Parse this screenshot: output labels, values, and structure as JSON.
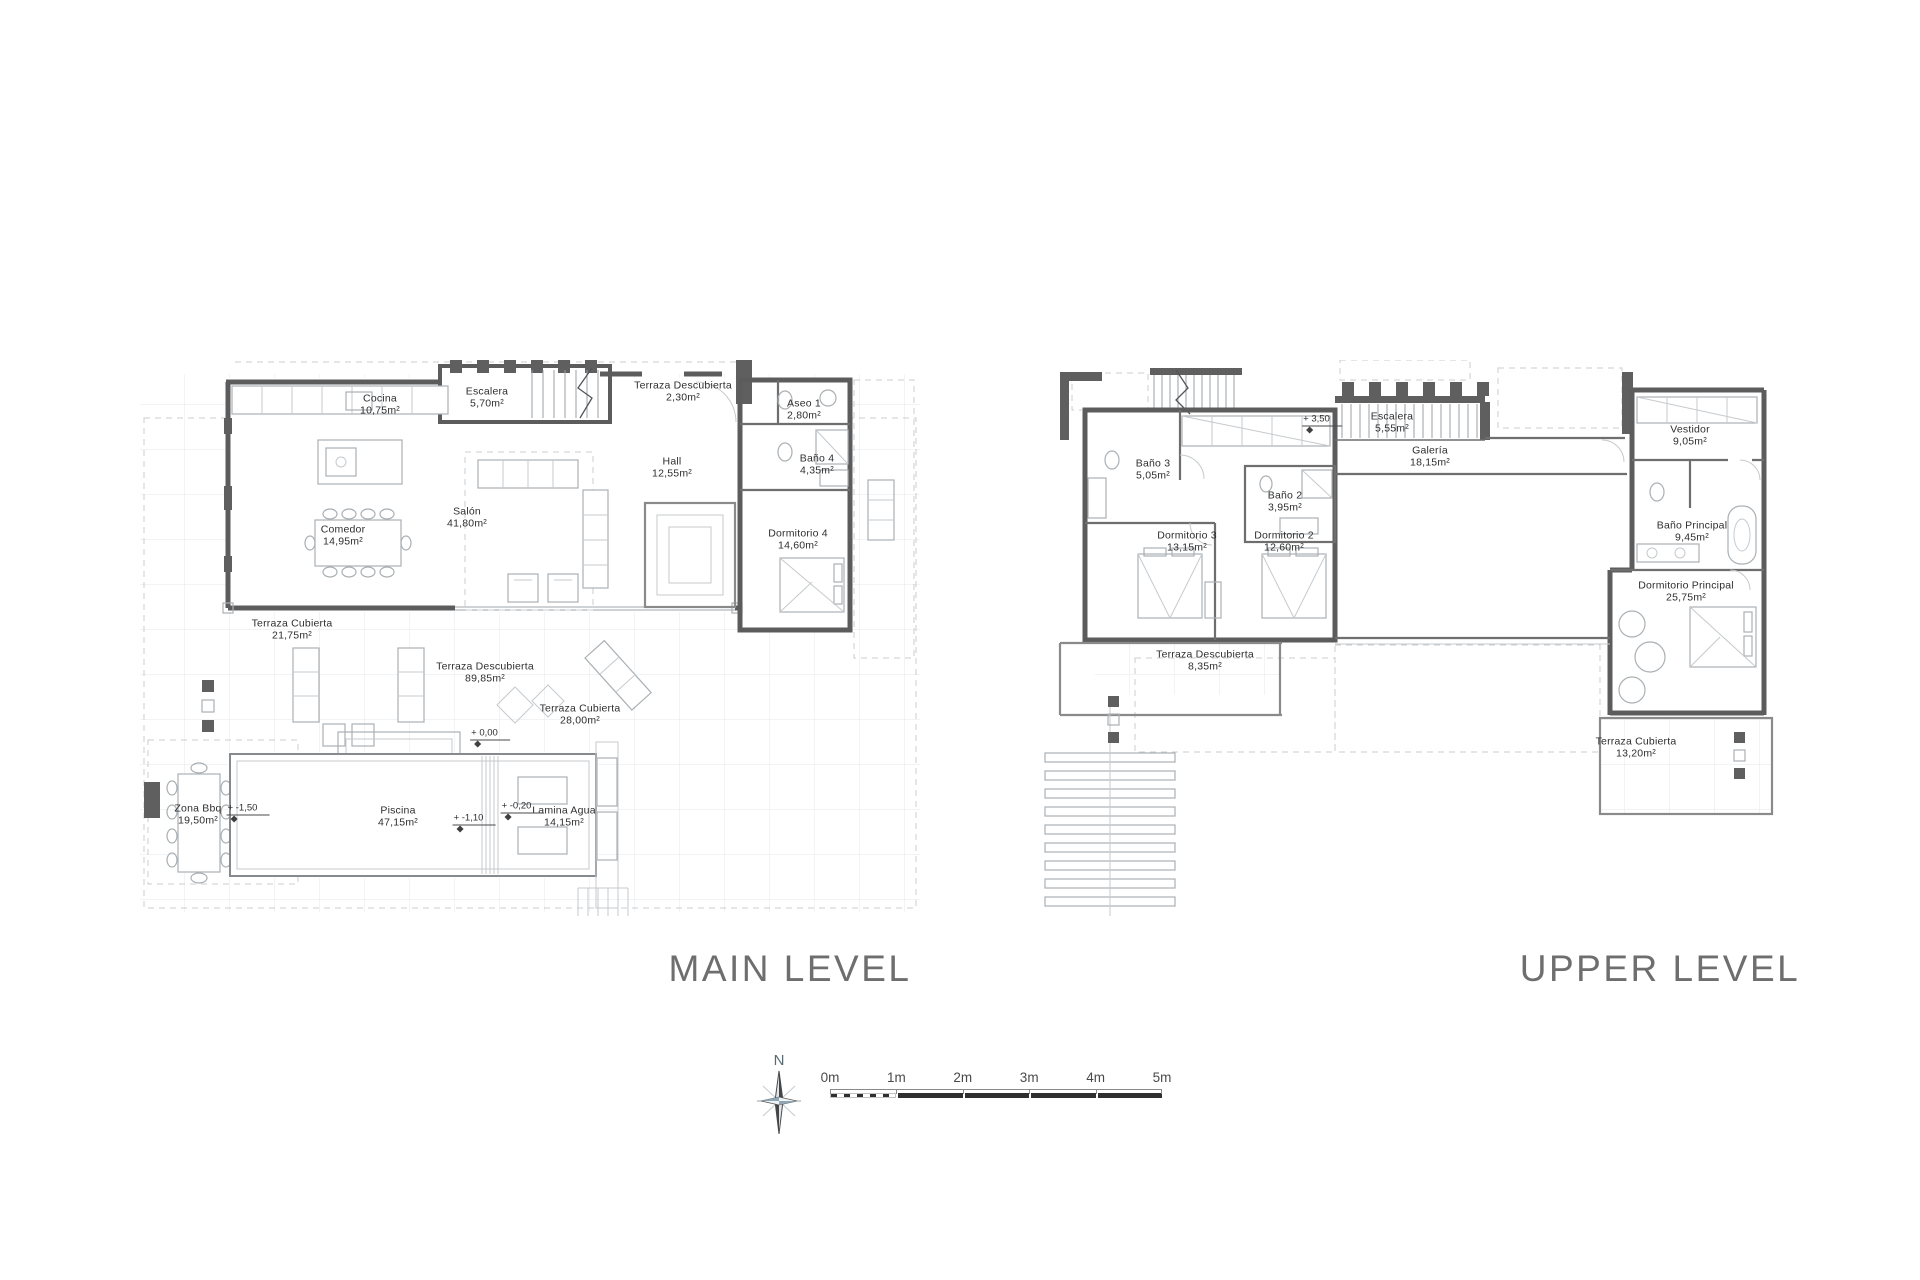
{
  "plans": {
    "main": {
      "title": "MAIN LEVEL",
      "rooms": [
        {
          "name": "Cocina",
          "area": "10,75m²"
        },
        {
          "name": "Escalera",
          "area": "5,70m²"
        },
        {
          "name": "Terraza Descubierta",
          "area": "2,30m²"
        },
        {
          "name": "Aseo 1",
          "area": "2,80m²"
        },
        {
          "name": "Baño 4",
          "area": "4,35m²"
        },
        {
          "name": "Hall",
          "area": "12,55m²"
        },
        {
          "name": "Salón",
          "area": "41,80m²"
        },
        {
          "name": "Comedor",
          "area": "14,95m²"
        },
        {
          "name": "Dormitorio 4",
          "area": "14,60m²"
        },
        {
          "name": "Terraza Cubierta",
          "area": "21,75m²"
        },
        {
          "name": "Terraza Descubierta",
          "area": "89,85m²"
        },
        {
          "name": "Terraza Cubierta",
          "area": "28,00m²"
        },
        {
          "name": "Piscina",
          "area": "47,15m²"
        },
        {
          "name": "Lamina Agua",
          "area": "14,15m²"
        },
        {
          "name": "Zona Bbq",
          "area": "19,50m²"
        }
      ],
      "levels": [
        {
          "label": "+ 0,00"
        },
        {
          "label": "+ -1,50"
        },
        {
          "label": "+ -1,10"
        },
        {
          "label": "+ -0,20"
        }
      ]
    },
    "upper": {
      "title": "UPPER LEVEL",
      "rooms": [
        {
          "name": "Baño 3",
          "area": "5,05m²"
        },
        {
          "name": "Escalera",
          "area": "5,55m²"
        },
        {
          "name": "Galería",
          "area": "18,15m²"
        },
        {
          "name": "Baño 2",
          "area": "3,95m²"
        },
        {
          "name": "Dormitorio 3",
          "area": "13,15m²"
        },
        {
          "name": "Dormitorio 2",
          "area": "12,60m²"
        },
        {
          "name": "Terraza Descubierta",
          "area": "8,35m²"
        },
        {
          "name": "Vestidor",
          "area": "9,05m²"
        },
        {
          "name": "Baño Principal",
          "area": "9,45m²"
        },
        {
          "name": "Dormitorio Principal",
          "area": "25,75m²"
        },
        {
          "name": "Terraza Cubierta",
          "area": "13,20m²"
        }
      ],
      "levels": [
        {
          "label": "+ 3,50"
        }
      ]
    }
  },
  "compass": {
    "label": "N"
  },
  "scale_bar": {
    "ticks": [
      "0m",
      "1m",
      "2m",
      "3m",
      "4m",
      "5m"
    ]
  },
  "colors": {
    "wall": "#5c5c5c",
    "partition": "#6e6e6e",
    "furniture": "#aab0b4",
    "grid": "#e4e7e9",
    "dashed": "#c9cccf",
    "label_text": "#2e2e2e",
    "title_text": "#6e6e6e",
    "compass_tint": "#b9cfdd",
    "scalebar_dark": "#2f2f2f"
  }
}
